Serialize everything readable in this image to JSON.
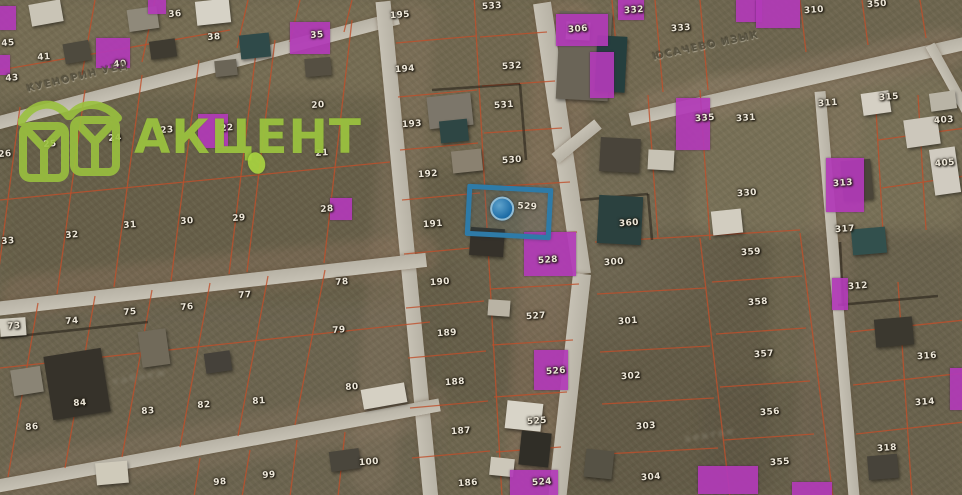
{
  "brand": {
    "name": "АКЦЕНТ",
    "color": "#9ac13f"
  },
  "selected_parcel": {
    "number": "529",
    "outline_color": "#2e7ba8",
    "marker": "blue-dot"
  },
  "streets": [
    {
      "name": "КУЕНОРИН УЕД",
      "x": 26,
      "y": 84,
      "rot": -13.5
    },
    {
      "name": "ЮСАЧЕВО ИЗЫК",
      "x": 652,
      "y": 52,
      "rot": -12
    }
  ],
  "ghost_labels": [
    {
      "text": "хабнеж",
      "x": 112,
      "y": 372,
      "rot": -10
    },
    {
      "text": "авитео",
      "x": 684,
      "y": 430,
      "rot": -9
    }
  ],
  "colors": {
    "grid": "#bf4f2b",
    "road": "#c3beb2",
    "purple": "#b23ab8",
    "blue": "#2e7ba8",
    "label": "#ece6d8",
    "terrain": "#6e664f"
  },
  "parcels": [
    {
      "n": "45",
      "x": 8,
      "y": 44
    },
    {
      "n": "43",
      "x": 12,
      "y": 79
    },
    {
      "n": "41",
      "x": 44,
      "y": 58
    },
    {
      "n": "36",
      "x": 175,
      "y": 15
    },
    {
      "n": "38",
      "x": 214,
      "y": 38
    },
    {
      "n": "35",
      "x": 317,
      "y": 36
    },
    {
      "n": "40",
      "x": 120,
      "y": 65
    },
    {
      "n": "26",
      "x": 5,
      "y": 155
    },
    {
      "n": "25",
      "x": 50,
      "y": 145
    },
    {
      "n": "24",
      "x": 115,
      "y": 139
    },
    {
      "n": "23",
      "x": 167,
      "y": 131
    },
    {
      "n": "22",
      "x": 227,
      "y": 129
    },
    {
      "n": "20",
      "x": 318,
      "y": 106
    },
    {
      "n": "21",
      "x": 322,
      "y": 154
    },
    {
      "n": "33",
      "x": 8,
      "y": 242
    },
    {
      "n": "32",
      "x": 72,
      "y": 236
    },
    {
      "n": "31",
      "x": 130,
      "y": 226
    },
    {
      "n": "30",
      "x": 187,
      "y": 222
    },
    {
      "n": "29",
      "x": 239,
      "y": 219
    },
    {
      "n": "28",
      "x": 327,
      "y": 210
    },
    {
      "n": "73",
      "x": 14,
      "y": 327
    },
    {
      "n": "74",
      "x": 72,
      "y": 322
    },
    {
      "n": "75",
      "x": 130,
      "y": 313
    },
    {
      "n": "76",
      "x": 187,
      "y": 308
    },
    {
      "n": "77",
      "x": 245,
      "y": 296
    },
    {
      "n": "78",
      "x": 342,
      "y": 283
    },
    {
      "n": "79",
      "x": 339,
      "y": 331
    },
    {
      "n": "86",
      "x": 32,
      "y": 428
    },
    {
      "n": "84",
      "x": 80,
      "y": 404
    },
    {
      "n": "83",
      "x": 148,
      "y": 412
    },
    {
      "n": "82",
      "x": 204,
      "y": 406
    },
    {
      "n": "81",
      "x": 259,
      "y": 402
    },
    {
      "n": "80",
      "x": 352,
      "y": 388
    },
    {
      "n": "98",
      "x": 220,
      "y": 483
    },
    {
      "n": "99",
      "x": 269,
      "y": 476
    },
    {
      "n": "100",
      "x": 369,
      "y": 463
    },
    {
      "n": "195",
      "x": 400,
      "y": 16
    },
    {
      "n": "194",
      "x": 405,
      "y": 70
    },
    {
      "n": "193",
      "x": 412,
      "y": 125
    },
    {
      "n": "192",
      "x": 428,
      "y": 175
    },
    {
      "n": "191",
      "x": 433,
      "y": 225
    },
    {
      "n": "190",
      "x": 440,
      "y": 283
    },
    {
      "n": "189",
      "x": 447,
      "y": 334
    },
    {
      "n": "188",
      "x": 455,
      "y": 383
    },
    {
      "n": "187",
      "x": 461,
      "y": 432
    },
    {
      "n": "186",
      "x": 468,
      "y": 484
    },
    {
      "n": "533",
      "x": 492,
      "y": 7
    },
    {
      "n": "532",
      "x": 512,
      "y": 67
    },
    {
      "n": "531",
      "x": 504,
      "y": 106
    },
    {
      "n": "530",
      "x": 512,
      "y": 161
    },
    {
      "n": "528",
      "x": 548,
      "y": 261
    },
    {
      "n": "527",
      "x": 536,
      "y": 317
    },
    {
      "n": "526",
      "x": 556,
      "y": 372
    },
    {
      "n": "525",
      "x": 537,
      "y": 422
    },
    {
      "n": "524",
      "x": 542,
      "y": 483
    },
    {
      "n": "306",
      "x": 578,
      "y": 30
    },
    {
      "n": "332",
      "x": 634,
      "y": 11
    },
    {
      "n": "333",
      "x": 681,
      "y": 29
    },
    {
      "n": "360",
      "x": 629,
      "y": 224
    },
    {
      "n": "300",
      "x": 614,
      "y": 263
    },
    {
      "n": "301",
      "x": 628,
      "y": 322
    },
    {
      "n": "302",
      "x": 631,
      "y": 377
    },
    {
      "n": "303",
      "x": 646,
      "y": 427
    },
    {
      "n": "304",
      "x": 651,
      "y": 478
    },
    {
      "n": "350",
      "x": 877,
      "y": 5
    },
    {
      "n": "310",
      "x": 814,
      "y": 11
    },
    {
      "n": "311",
      "x": 828,
      "y": 104
    },
    {
      "n": "315",
      "x": 889,
      "y": 98
    },
    {
      "n": "335",
      "x": 705,
      "y": 119
    },
    {
      "n": "331",
      "x": 746,
      "y": 119
    },
    {
      "n": "330",
      "x": 747,
      "y": 194
    },
    {
      "n": "403",
      "x": 944,
      "y": 121
    },
    {
      "n": "405",
      "x": 945,
      "y": 164
    },
    {
      "n": "313",
      "x": 843,
      "y": 184
    },
    {
      "n": "317",
      "x": 845,
      "y": 230
    },
    {
      "n": "359",
      "x": 751,
      "y": 253
    },
    {
      "n": "358",
      "x": 758,
      "y": 303
    },
    {
      "n": "357",
      "x": 764,
      "y": 355
    },
    {
      "n": "356",
      "x": 770,
      "y": 413
    },
    {
      "n": "355",
      "x": 780,
      "y": 463
    },
    {
      "n": "312",
      "x": 858,
      "y": 287
    },
    {
      "n": "316",
      "x": 927,
      "y": 357
    },
    {
      "n": "314",
      "x": 925,
      "y": 403
    },
    {
      "n": "318",
      "x": 887,
      "y": 449
    }
  ],
  "highlights": [
    {
      "x": 0,
      "y": 6,
      "w": 16,
      "h": 24
    },
    {
      "x": 0,
      "y": 55,
      "w": 10,
      "h": 20
    },
    {
      "x": 148,
      "y": 0,
      "w": 18,
      "h": 14
    },
    {
      "x": 96,
      "y": 38,
      "w": 34,
      "h": 30
    },
    {
      "x": 290,
      "y": 22,
      "w": 40,
      "h": 32
    },
    {
      "x": 198,
      "y": 114,
      "w": 30,
      "h": 34
    },
    {
      "x": 330,
      "y": 198,
      "w": 22,
      "h": 22
    },
    {
      "x": 618,
      "y": 0,
      "w": 26,
      "h": 20
    },
    {
      "x": 736,
      "y": 0,
      "w": 26,
      "h": 22
    },
    {
      "x": 756,
      "y": 0,
      "w": 44,
      "h": 28
    },
    {
      "x": 556,
      "y": 14,
      "w": 52,
      "h": 32
    },
    {
      "x": 590,
      "y": 52,
      "w": 24,
      "h": 46
    },
    {
      "x": 676,
      "y": 98,
      "w": 34,
      "h": 52
    },
    {
      "x": 826,
      "y": 158,
      "w": 38,
      "h": 54
    },
    {
      "x": 832,
      "y": 278,
      "w": 16,
      "h": 32
    },
    {
      "x": 950,
      "y": 368,
      "w": 12,
      "h": 42
    },
    {
      "x": 524,
      "y": 232,
      "w": 52,
      "h": 44
    },
    {
      "x": 534,
      "y": 350,
      "w": 34,
      "h": 40
    },
    {
      "x": 510,
      "y": 470,
      "w": 48,
      "h": 25
    },
    {
      "x": 698,
      "y": 466,
      "w": 60,
      "h": 28
    },
    {
      "x": 792,
      "y": 482,
      "w": 40,
      "h": 13
    }
  ],
  "roads": [
    {
      "x": -8,
      "y": 118,
      "len": 420,
      "w": 13,
      "rot": -14.7
    },
    {
      "x": 383,
      "y": -6,
      "len": 510,
      "w": 15,
      "rot": 84.5
    },
    {
      "x": 542,
      "y": -6,
      "len": 274,
      "w": 18,
      "rot": 81.6
    },
    {
      "x": 582,
      "y": 265,
      "len": 238,
      "w": 18,
      "rot": 96.3
    },
    {
      "x": -5,
      "y": 302,
      "len": 434,
      "w": 14,
      "rot": -6.5
    },
    {
      "x": -5,
      "y": 480,
      "len": 452,
      "w": 13,
      "rot": -10.4
    },
    {
      "x": 630,
      "y": 113,
      "len": 342,
      "w": 13,
      "rot": -12.8
    },
    {
      "x": 598,
      "y": 118,
      "len": 55,
      "w": 12,
      "rot": 141
    },
    {
      "x": 930,
      "y": 40,
      "len": 88,
      "w": 10,
      "rot": 61
    },
    {
      "x": 820,
      "y": 86,
      "len": 416,
      "w": 11,
      "rot": 85.2
    }
  ],
  "grid_lines": [
    [
      20,
      107,
      -5,
      299
    ],
    [
      85,
      90,
      57,
      294
    ],
    [
      142,
      75,
      114,
      287
    ],
    [
      199,
      60,
      171,
      281
    ],
    [
      257,
      44,
      229,
      274
    ],
    [
      275,
      40,
      247,
      272
    ],
    [
      352,
      20,
      324,
      263
    ],
    [
      0,
      200,
      390,
      162
    ],
    [
      95,
      0,
      82,
      75
    ],
    [
      155,
      0,
      142,
      62
    ],
    [
      248,
      0,
      237,
      48
    ],
    [
      300,
      0,
      290,
      42
    ],
    [
      352,
      0,
      344,
      32
    ],
    [
      0,
      70,
      230,
      30
    ],
    [
      38,
      303,
      8,
      477
    ],
    [
      95,
      296,
      65,
      468
    ],
    [
      152,
      290,
      122,
      457
    ],
    [
      210,
      283,
      180,
      447
    ],
    [
      268,
      276,
      238,
      436
    ],
    [
      325,
      270,
      295,
      425
    ],
    [
      0,
      368,
      430,
      322
    ],
    [
      200,
      458,
      194,
      497
    ],
    [
      250,
      450,
      242,
      497
    ],
    [
      297,
      440,
      290,
      497
    ],
    [
      345,
      432,
      338,
      497
    ],
    [
      474,
      -5,
      502,
      497
    ],
    [
      396,
      43,
      476,
      36
    ],
    [
      398,
      97,
      477,
      90
    ],
    [
      400,
      150,
      478,
      143
    ],
    [
      402,
      200,
      480,
      193
    ],
    [
      404,
      254,
      482,
      247
    ],
    [
      406,
      308,
      484,
      301
    ],
    [
      408,
      358,
      486,
      351
    ],
    [
      410,
      408,
      488,
      401
    ],
    [
      412,
      458,
      490,
      451
    ],
    [
      480,
      37,
      547,
      32
    ],
    [
      482,
      86,
      555,
      81
    ],
    [
      484,
      133,
      562,
      128
    ],
    [
      486,
      187,
      570,
      182
    ],
    [
      488,
      237,
      577,
      232
    ],
    [
      490,
      289,
      579,
      284
    ],
    [
      492,
      345,
      573,
      340
    ],
    [
      494,
      397,
      567,
      392
    ],
    [
      496,
      452,
      561,
      447
    ],
    [
      700,
      238,
      730,
      497
    ],
    [
      595,
      242,
      800,
      230
    ],
    [
      597,
      294,
      706,
      288
    ],
    [
      600,
      352,
      710,
      346
    ],
    [
      602,
      404,
      714,
      398
    ],
    [
      604,
      454,
      718,
      448
    ],
    [
      648,
      95,
      658,
      238
    ],
    [
      700,
      90,
      710,
      240
    ],
    [
      612,
      0,
      620,
      90
    ],
    [
      655,
      0,
      663,
      92
    ],
    [
      700,
      0,
      708,
      90
    ],
    [
      800,
      233,
      833,
      497
    ],
    [
      712,
      282,
      802,
      276
    ],
    [
      716,
      334,
      806,
      328
    ],
    [
      720,
      387,
      810,
      381
    ],
    [
      724,
      440,
      814,
      434
    ],
    [
      850,
      332,
      965,
      320
    ],
    [
      853,
      385,
      965,
      373
    ],
    [
      856,
      434,
      965,
      422
    ],
    [
      898,
      282,
      912,
      497
    ],
    [
      878,
      140,
      965,
      128
    ],
    [
      882,
      188,
      965,
      176
    ],
    [
      875,
      92,
      883,
      232
    ],
    [
      918,
      95,
      926,
      230
    ],
    [
      800,
      0,
      806,
      52
    ],
    [
      862,
      0,
      868,
      45
    ],
    [
      920,
      0,
      926,
      38
    ]
  ],
  "dark_lines": [
    [
      580,
      200,
      648,
      194
    ],
    [
      648,
      194,
      652,
      240
    ],
    [
      838,
      305,
      938,
      296
    ],
    [
      840,
      242,
      843,
      306
    ],
    [
      0,
      338,
      148,
      322
    ],
    [
      432,
      90,
      520,
      84
    ],
    [
      520,
      84,
      526,
      160
    ]
  ],
  "buildings": [
    {
      "x": 30,
      "y": 2,
      "w": 32,
      "h": 22,
      "c": "#c9c4b6",
      "r": -10
    },
    {
      "x": 64,
      "y": 42,
      "w": 26,
      "h": 20,
      "c": "#4e4a3e",
      "r": -10
    },
    {
      "x": 128,
      "y": 8,
      "w": 30,
      "h": 22,
      "c": "#8f897a",
      "r": -8
    },
    {
      "x": 150,
      "y": 40,
      "w": 26,
      "h": 18,
      "c": "#3f3b31",
      "r": -8
    },
    {
      "x": 196,
      "y": 0,
      "w": 34,
      "h": 24,
      "c": "#d6d2c6",
      "r": -6
    },
    {
      "x": 240,
      "y": 34,
      "w": 30,
      "h": 24,
      "c": "#2f4a49",
      "r": -6
    },
    {
      "x": 215,
      "y": 60,
      "w": 22,
      "h": 16,
      "c": "#6b6557",
      "r": -6
    },
    {
      "x": 305,
      "y": 58,
      "w": 26,
      "h": 18,
      "c": "#554f42",
      "r": -5
    },
    {
      "x": 0,
      "y": 318,
      "w": 26,
      "h": 18,
      "c": "#d2cec1",
      "r": -4
    },
    {
      "x": 48,
      "y": 352,
      "w": 58,
      "h": 64,
      "c": "#36322a",
      "r": -9
    },
    {
      "x": 12,
      "y": 368,
      "w": 30,
      "h": 26,
      "c": "#8a8475",
      "r": -9
    },
    {
      "x": 96,
      "y": 462,
      "w": 32,
      "h": 22,
      "c": "#cfcaba",
      "r": -5
    },
    {
      "x": 140,
      "y": 330,
      "w": 28,
      "h": 36,
      "c": "#716a5a",
      "r": -8
    },
    {
      "x": 205,
      "y": 352,
      "w": 26,
      "h": 20,
      "c": "#45413a",
      "r": -8
    },
    {
      "x": 362,
      "y": 386,
      "w": 44,
      "h": 20,
      "c": "#d5d0c3",
      "r": -10
    },
    {
      "x": 330,
      "y": 450,
      "w": 30,
      "h": 20,
      "c": "#4a463c",
      "r": -8
    },
    {
      "x": 428,
      "y": 95,
      "w": 44,
      "h": 32,
      "c": "#7c766a",
      "r": -6
    },
    {
      "x": 440,
      "y": 120,
      "w": 28,
      "h": 22,
      "c": "#2e4644",
      "r": -6
    },
    {
      "x": 452,
      "y": 150,
      "w": 30,
      "h": 22,
      "c": "#8a8170",
      "r": -6
    },
    {
      "x": 470,
      "y": 228,
      "w": 34,
      "h": 28,
      "c": "#35312a",
      "r": 4
    },
    {
      "x": 488,
      "y": 300,
      "w": 22,
      "h": 16,
      "c": "#b9b3a4",
      "r": 4
    },
    {
      "x": 506,
      "y": 402,
      "w": 36,
      "h": 28,
      "c": "#d8d4c8",
      "r": 6
    },
    {
      "x": 520,
      "y": 432,
      "w": 30,
      "h": 34,
      "c": "#302e27",
      "r": 6
    },
    {
      "x": 490,
      "y": 458,
      "w": 24,
      "h": 18,
      "c": "#ccc7b9",
      "r": 6
    },
    {
      "x": 585,
      "y": 450,
      "w": 28,
      "h": 28,
      "c": "#565245",
      "r": 6
    },
    {
      "x": 558,
      "y": 12,
      "w": 52,
      "h": 88,
      "c": "#6a6457",
      "r": 3
    },
    {
      "x": 596,
      "y": 36,
      "w": 30,
      "h": 56,
      "c": "#253f3e",
      "r": 3
    },
    {
      "x": 566,
      "y": 22,
      "w": 24,
      "h": 18,
      "c": "#d3cfc2",
      "r": 3
    },
    {
      "x": 600,
      "y": 138,
      "w": 40,
      "h": 34,
      "c": "#49443a",
      "r": 3
    },
    {
      "x": 598,
      "y": 196,
      "w": 44,
      "h": 48,
      "c": "#2b413f",
      "r": 3
    },
    {
      "x": 648,
      "y": 150,
      "w": 26,
      "h": 20,
      "c": "#c7c2b4",
      "r": 3
    },
    {
      "x": 712,
      "y": 210,
      "w": 30,
      "h": 24,
      "c": "#d2cdc0",
      "r": -6
    },
    {
      "x": 852,
      "y": 228,
      "w": 34,
      "h": 26,
      "c": "#32504d",
      "r": -5
    },
    {
      "x": 842,
      "y": 160,
      "w": 30,
      "h": 40,
      "c": "#4a4539",
      "r": -5
    },
    {
      "x": 875,
      "y": 318,
      "w": 38,
      "h": 28,
      "c": "#3b382f",
      "r": -5
    },
    {
      "x": 905,
      "y": 118,
      "w": 34,
      "h": 28,
      "c": "#ccc7bb",
      "r": -8
    },
    {
      "x": 932,
      "y": 148,
      "w": 26,
      "h": 46,
      "c": "#d0cbc0",
      "r": -8
    },
    {
      "x": 862,
      "y": 92,
      "w": 28,
      "h": 22,
      "c": "#d5d0c4",
      "r": -8
    },
    {
      "x": 930,
      "y": 92,
      "w": 26,
      "h": 18,
      "c": "#b9b4a6",
      "r": -8
    },
    {
      "x": 868,
      "y": 455,
      "w": 30,
      "h": 24,
      "c": "#47433a",
      "r": -5
    }
  ],
  "terrain": [
    {
      "x": 0,
      "y": 0,
      "w": 390,
      "h": 120,
      "c": "#7d7459",
      "o": 0.55
    },
    {
      "x": 0,
      "y": 95,
      "w": 395,
      "h": 215,
      "c": "#615a44",
      "o": 0.5
    },
    {
      "x": 0,
      "y": 300,
      "w": 440,
      "h": 200,
      "c": "#6b6350",
      "o": 0.5
    },
    {
      "x": 390,
      "y": 0,
      "w": 175,
      "h": 260,
      "c": "#756c52",
      "o": 0.45
    },
    {
      "x": 420,
      "y": 170,
      "w": 150,
      "h": 240,
      "c": "#5d5642",
      "o": 0.45
    },
    {
      "x": 560,
      "y": 0,
      "w": 145,
      "h": 110,
      "c": "#7b7258",
      "o": 0.4
    },
    {
      "x": 560,
      "y": 230,
      "w": 210,
      "h": 270,
      "c": "#564f3e",
      "o": 0.45
    },
    {
      "x": 690,
      "y": 75,
      "w": 272,
      "h": 160,
      "c": "#837a60",
      "o": 0.5
    },
    {
      "x": 800,
      "y": 230,
      "w": 162,
      "h": 270,
      "c": "#675f4c",
      "o": 0.5
    },
    {
      "x": 700,
      "y": 380,
      "w": 130,
      "h": 115,
      "c": "#5a5342",
      "o": 0.4
    }
  ],
  "dirt_bands": [
    {
      "x": 520,
      "y": 0,
      "w": 60,
      "h": 495,
      "c": "#9b7c66",
      "o": 0.3,
      "r": 4
    },
    {
      "x": 370,
      "y": 0,
      "w": 45,
      "h": 495,
      "c": "#96806c",
      "o": 0.25,
      "r": 5
    },
    {
      "x": 0,
      "y": 255,
      "w": 440,
      "h": 40,
      "c": "#9b7c66",
      "o": 0.28,
      "r": -6
    },
    {
      "x": 0,
      "y": 420,
      "w": 450,
      "h": 45,
      "c": "#96806c",
      "o": 0.25,
      "r": -10
    },
    {
      "x": 630,
      "y": 60,
      "w": 340,
      "h": 40,
      "c": "#a08673",
      "o": 0.3,
      "r": -12
    },
    {
      "x": 805,
      "y": 90,
      "w": 45,
      "h": 410,
      "c": "#8e7a66",
      "o": 0.25,
      "r": 4
    }
  ]
}
